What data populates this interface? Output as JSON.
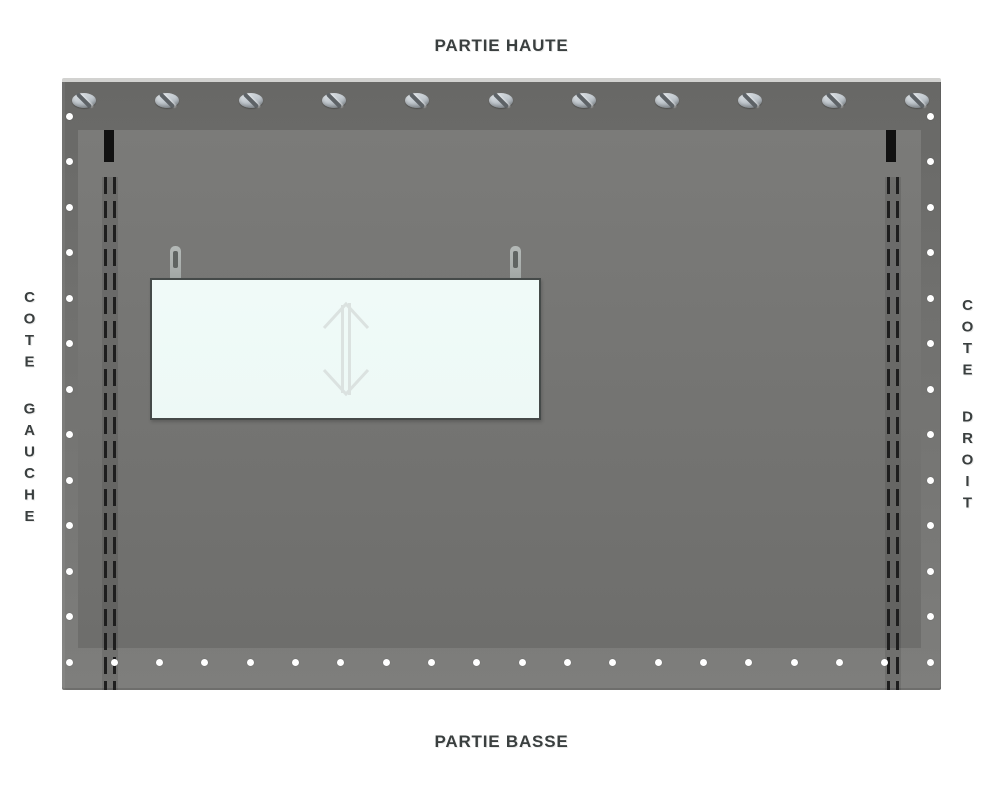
{
  "labels": {
    "top": "PARTIE HAUTE",
    "bottom": "PARTIE BASSE",
    "left_side": "COTE GAUCHE",
    "right_side": "COTE DROIT"
  },
  "tarp": {
    "hardware": {
      "top_grommets": 11,
      "side_dots_per_column": 12,
      "bottom_dots": 20,
      "stitch_seams": 2,
      "corner_marker_bars": 2
    },
    "window_panel": {
      "hooks": 2,
      "icon": "vertical-resize-arrow"
    }
  },
  "colors": {
    "page_bg": "#ffffff",
    "label_text": "#3a3f3f",
    "tarp_top": "#686866",
    "tarp_bottom": "#7e7e7c",
    "inner_top": "#7b7b79",
    "inner_bottom": "#6e6e6c",
    "stitch": "#1e1e1e",
    "marker_bar": "#111111",
    "dot": "#ffffff",
    "grommet_light": "#d6dbdf",
    "grommet_dark": "#969da3",
    "grommet_slot": "#5d6266",
    "hook": "#a8adab",
    "panel_fill": "#edf9f6",
    "panel_border": "#454a49",
    "arrow": "#dbe2e0"
  }
}
